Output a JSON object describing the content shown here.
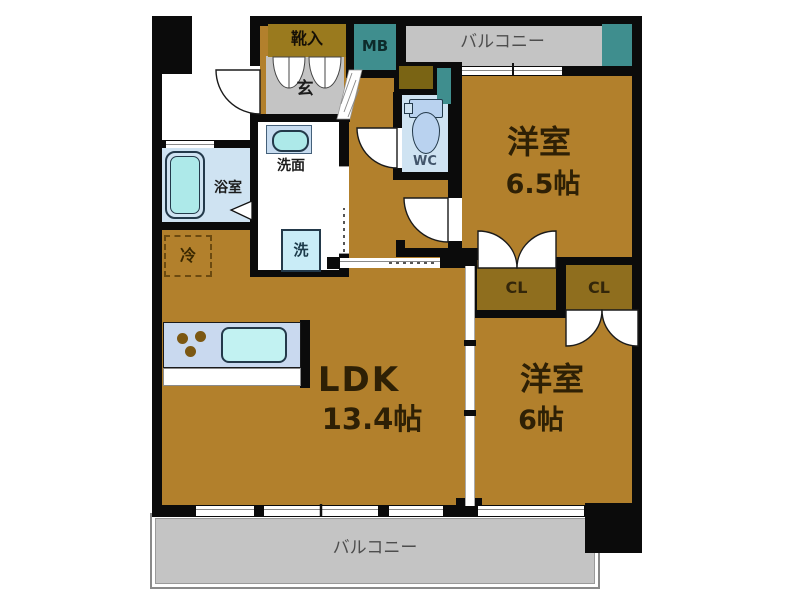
{
  "plan": {
    "rooms": {
      "ldk": {
        "label": "LDK",
        "area": "13.4帖"
      },
      "western1": {
        "label": "洋室",
        "area": "6.5帖"
      },
      "western2": {
        "label": "洋室",
        "area": "6帖"
      },
      "genkan": {
        "label": "玄"
      },
      "shoe_cabinet": {
        "label": "靴入"
      },
      "meter_box": {
        "label": "MB"
      },
      "wc": {
        "label": "WC"
      },
      "washroom": {
        "label": "洗面"
      },
      "bathroom": {
        "label": "浴室"
      }
    },
    "fixtures": {
      "washer": {
        "label": "洗"
      },
      "refrigerator": {
        "label": "冷"
      }
    },
    "closets": [
      {
        "label": "CL"
      },
      {
        "label": "CL"
      }
    ],
    "balconies": {
      "top": {
        "label": "バルコニー"
      },
      "bottom": {
        "label": "バルコニー"
      }
    },
    "colors": {
      "floor": "#b2802c",
      "closet": "#8f6e1e",
      "shoe_box": "#9a7a1e",
      "teal": "#3f8e8e",
      "gray": "#c4c4c4",
      "wet_blue": "#cfe3f2",
      "fixture_cyan": "#ade9e9",
      "wall": "#0b0b0b"
    }
  }
}
